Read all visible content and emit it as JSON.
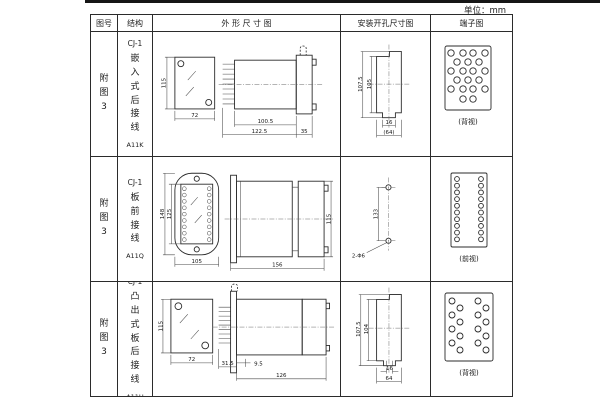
{
  "unit_label": "单位：mm",
  "headers": {
    "fig_no": "图号",
    "structure": "结构",
    "outline": "外 形 尺 寸 图",
    "mounting": "安装开孔尺寸图",
    "terminal": "端子图"
  },
  "rows": [
    {
      "fig_no": "附图3",
      "model": "CJ-1",
      "type": "嵌入式后接线",
      "code": "A11K",
      "outline": {
        "height": "115",
        "width": "72",
        "depth": "100.5",
        "depth_total": "122.5",
        "flange": "35"
      },
      "mounting": {
        "outer_h": "107.5",
        "inner_h": "105",
        "slot_w": "16",
        "overall_w": "(64)"
      },
      "terminal_caption": "(背视)"
    },
    {
      "fig_no": "附图3",
      "model": "CJ-1",
      "type": "板前接线",
      "code": "A11Q",
      "outline": {
        "outer_h": "148",
        "inner_h": "125",
        "width": "105",
        "depth": "156",
        "height": "115"
      },
      "mounting": {
        "hole_span": "133",
        "hole_label": "2-Φ6"
      },
      "terminal_caption": "(前视)"
    },
    {
      "fig_no": "附图3",
      "model": "CJ-1",
      "type": "凸出式板后接线",
      "code": "A11H",
      "outline": {
        "height": "115",
        "width": "72",
        "tail": "31.5",
        "offset": "9.5",
        "depth": "126"
      },
      "mounting": {
        "outer_h": "107.5",
        "inner_h": "104",
        "slot_w": "16",
        "overall_w": "64"
      },
      "terminal_caption": "(背视)"
    }
  ]
}
